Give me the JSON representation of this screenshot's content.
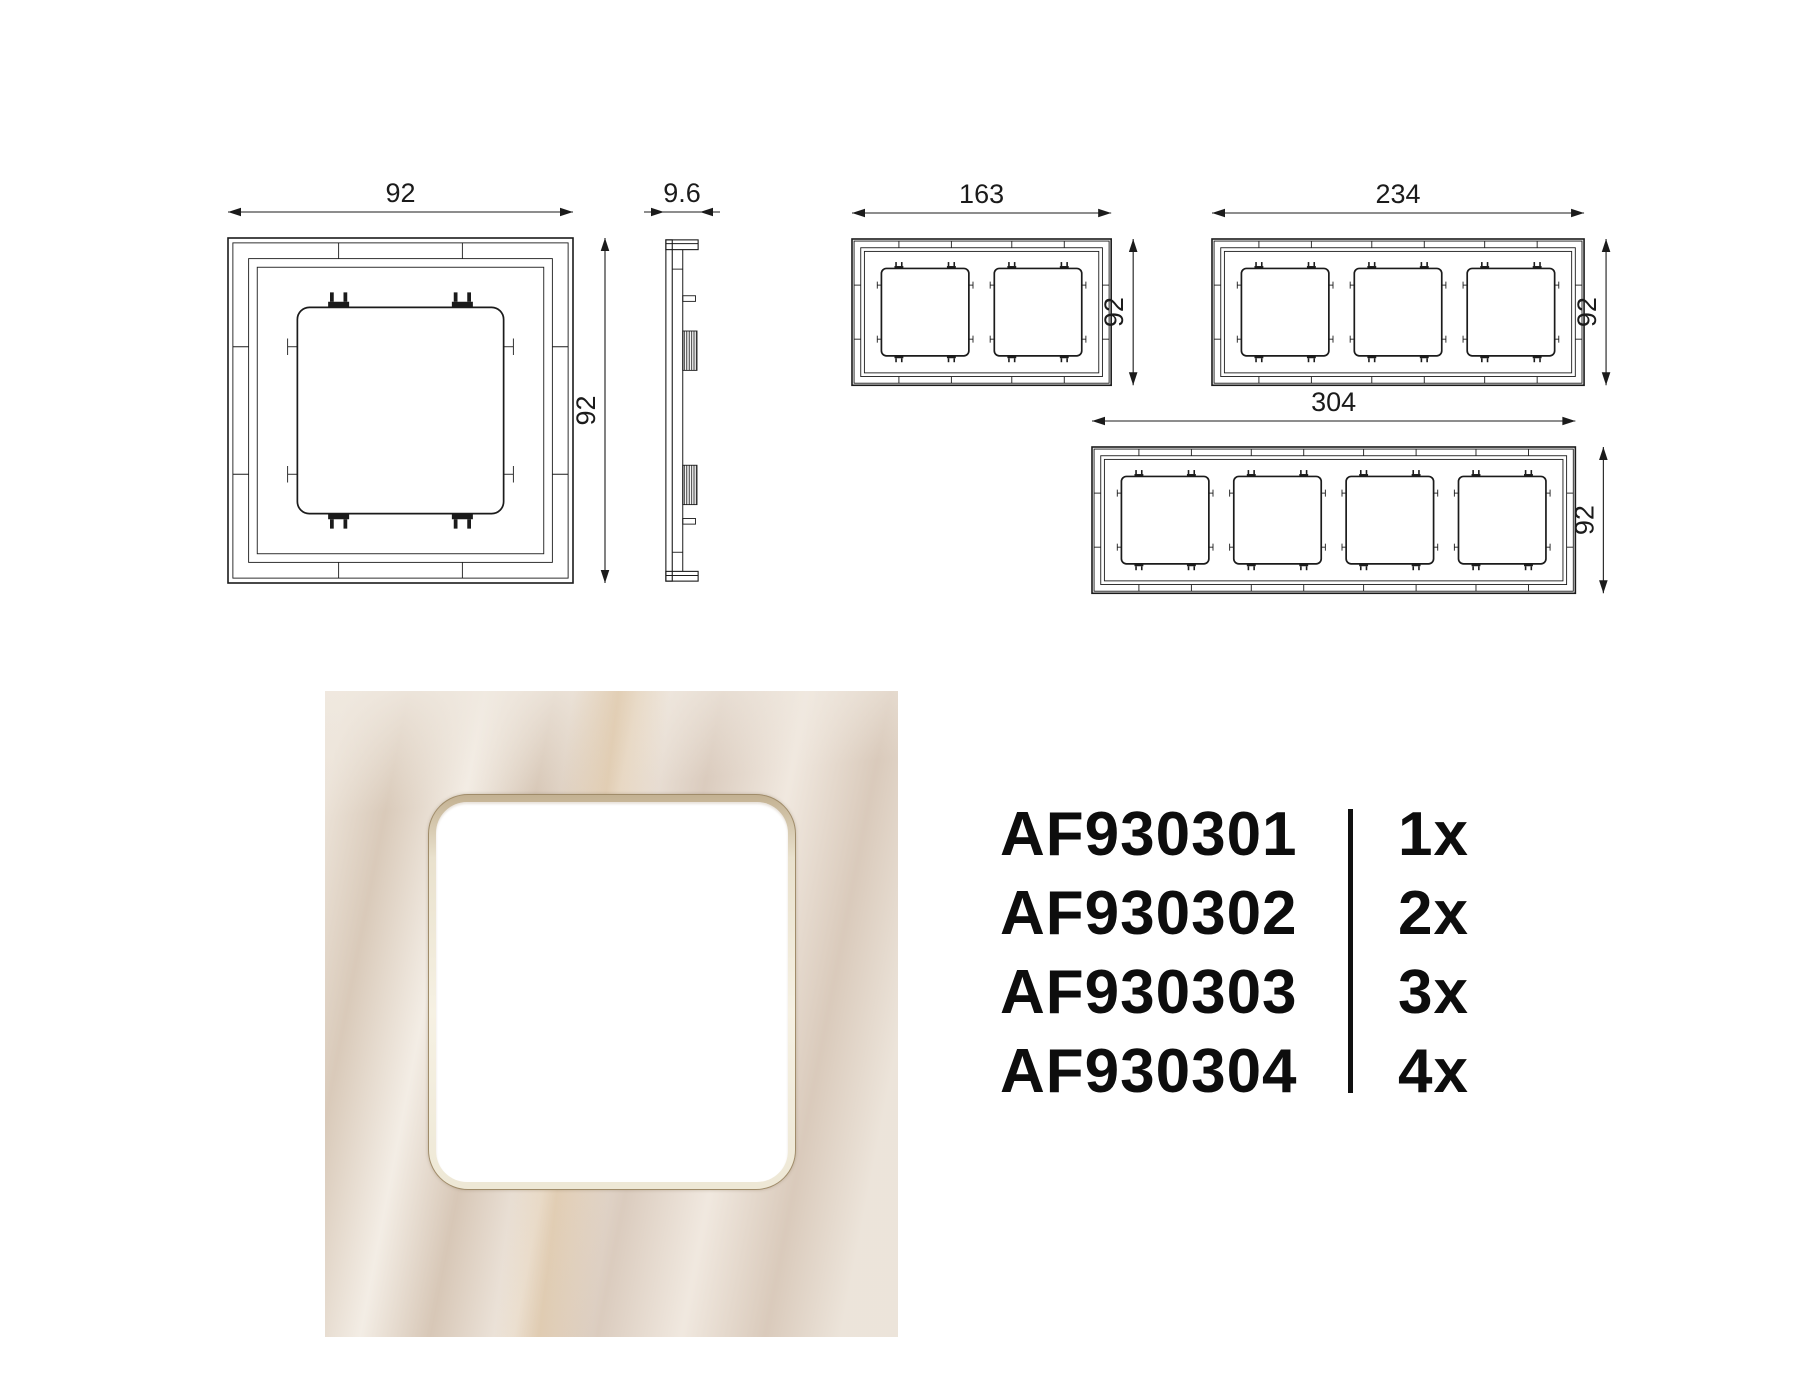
{
  "drawings": {
    "front_views": [
      {
        "gangs": 1,
        "width_label": "92",
        "height_label": "92"
      },
      {
        "gangs": 2,
        "width_label": "163",
        "height_label": "92"
      },
      {
        "gangs": 3,
        "width_label": "234",
        "height_label": "92"
      },
      {
        "gangs": 4,
        "width_label": "304",
        "height_label": "92"
      }
    ],
    "side_view": {
      "thickness_label": "9.6"
    }
  },
  "parts_list": {
    "rows": [
      {
        "code": "AF930301",
        "qty": "1x"
      },
      {
        "code": "AF930302",
        "qty": "2x"
      },
      {
        "code": "AF930303",
        "qty": "3x"
      },
      {
        "code": "AF930304",
        "qty": "4x"
      }
    ]
  },
  "colors": {
    "ink": "#1b1b1b",
    "marble_base": "#e4dbd1",
    "marble_streak": "#cea874",
    "window_ring": "#f6f1e3",
    "window_fill": "#ffffff"
  }
}
